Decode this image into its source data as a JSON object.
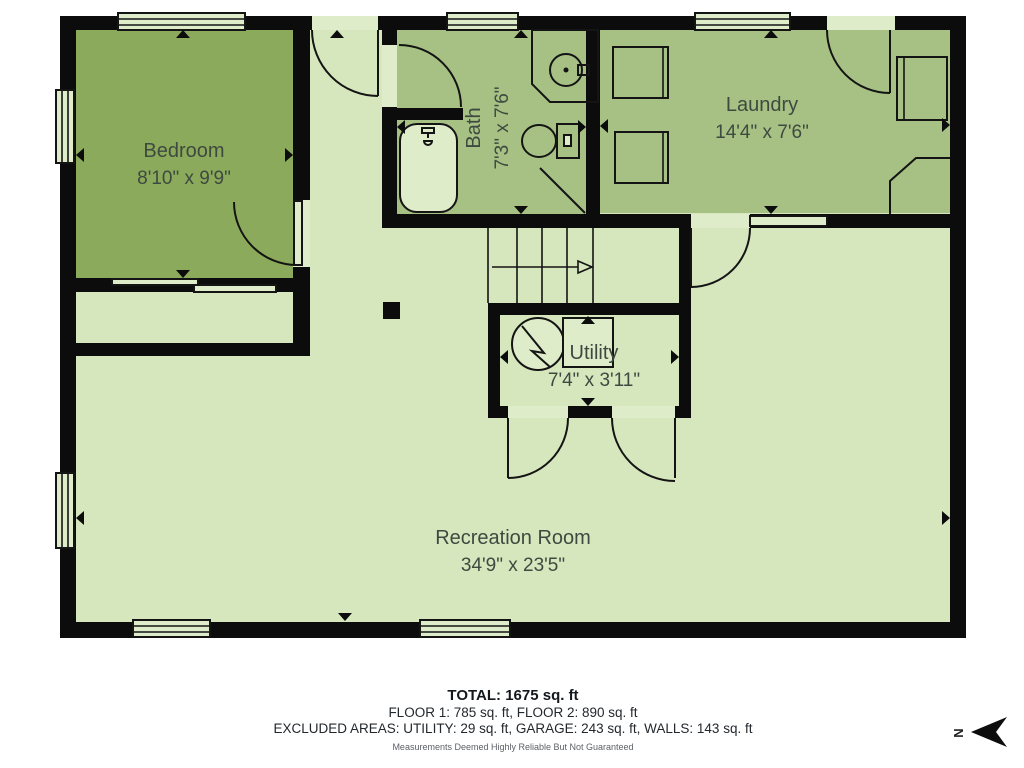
{
  "plan": {
    "rooms": {
      "bedroom": {
        "name": "Bedroom",
        "dims": "8'10\" x 9'9\""
      },
      "bath": {
        "name": "Bath",
        "dims": "7'3\" x 7'6\""
      },
      "laundry": {
        "name": "Laundry",
        "dims": "14'4\" x 7'6\""
      },
      "utility": {
        "name": "Utility",
        "dims": "7'4\" x 3'11\""
      },
      "recreation": {
        "name": "Recreation Room",
        "dims": "34'9\" x 23'5\""
      }
    },
    "compass": {
      "label": "N"
    },
    "colors": {
      "wall": "#0c0c0c",
      "room_pale": "#d6e7be",
      "room_mid": "#a6c183",
      "room_dark": "#8caa5b",
      "label_text": "#3e4a40"
    }
  },
  "footer": {
    "total": "TOTAL: 1675 sq. ft",
    "floors": "FLOOR 1: 785 sq. ft, FLOOR 2: 890 sq. ft",
    "excluded": "EXCLUDED AREAS: UTILITY: 29 sq. ft, GARAGE: 243 sq. ft, WALLS: 143 sq. ft",
    "disclaimer": "Measurements Deemed Highly Reliable But Not Guaranteed"
  }
}
